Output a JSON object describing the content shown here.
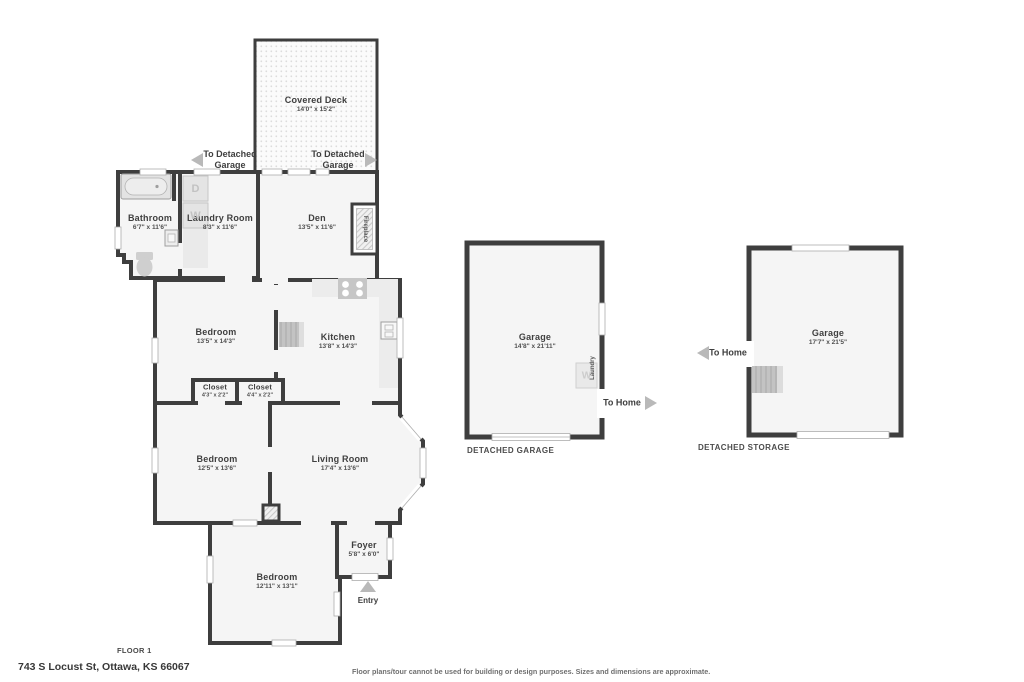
{
  "page": {
    "floor_label": "FLOOR 1",
    "address": "743 S Locust St, Ottawa, KS 66067",
    "disclaimer": "Floor plans/tour cannot be used for building or design purposes. Sizes and dimensions are approximate."
  },
  "colors": {
    "wall": "#3e3e3e",
    "room_fill": "#f5f5f5",
    "arrow_gray": "#b9b9b9"
  },
  "rooms": {
    "covered_deck": {
      "name": "Covered Deck",
      "dims": "14'0\" x 15'2\""
    },
    "bathroom": {
      "name": "Bathroom",
      "dims": "6'7\" x 11'6\""
    },
    "laundry_room": {
      "name": "Laundry Room",
      "dims": "8'3\" x 11'6\""
    },
    "den": {
      "name": "Den",
      "dims": "13'5\" x 11'6\""
    },
    "bedroom_top": {
      "name": "Bedroom",
      "dims": "13'5\" x 14'3\""
    },
    "kitchen": {
      "name": "Kitchen",
      "dims": "13'8\" x 14'3\""
    },
    "closet_left": {
      "name": "Closet",
      "dims": "4'3\" x 2'2\""
    },
    "closet_right": {
      "name": "Closet",
      "dims": "4'4\" x 2'2\""
    },
    "bedroom_mid": {
      "name": "Bedroom",
      "dims": "12'5\" x 13'6\""
    },
    "living_room": {
      "name": "Living Room",
      "dims": "17'4\" x 13'6\""
    },
    "bedroom_bottom": {
      "name": "Bedroom",
      "dims": "12'11\" x 13'1\""
    },
    "foyer": {
      "name": "Foyer",
      "dims": "5'8\" x 6'0\""
    },
    "detached_garage": {
      "name": "Garage",
      "dims": "14'8\" x 21'11\"",
      "caption": "DETACHED GARAGE"
    },
    "detached_storage": {
      "name": "Garage",
      "dims": "17'7\" x 21'5\"",
      "caption": "DETACHED STORAGE"
    }
  },
  "features": {
    "fireplace": "Fireplace",
    "laundry": "Laundry",
    "dryer": "D",
    "washer": "W",
    "garage_washer": "W"
  },
  "nav": {
    "to_detached_line1": "To Detached",
    "to_detached_line2": "Garage",
    "to_home": "To Home",
    "entry": "Entry"
  }
}
